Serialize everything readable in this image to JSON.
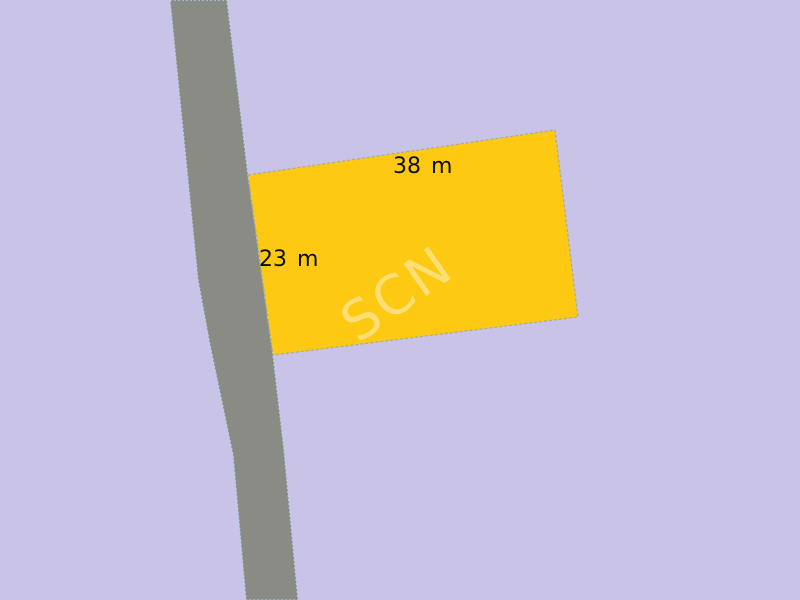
{
  "map": {
    "background_color": "#c9c3e8",
    "road": {
      "fill_color": "#8b8b86",
      "edge_color": "#aed4ea"
    },
    "parcel": {
      "fill_color": "#fdc913",
      "outline_color": "#a3ab9c",
      "width_label": "38 m",
      "depth_label": "23 m",
      "label_color": "#0d0d0d",
      "watermark": "SCN",
      "watermark_color": "#ffffff"
    }
  }
}
